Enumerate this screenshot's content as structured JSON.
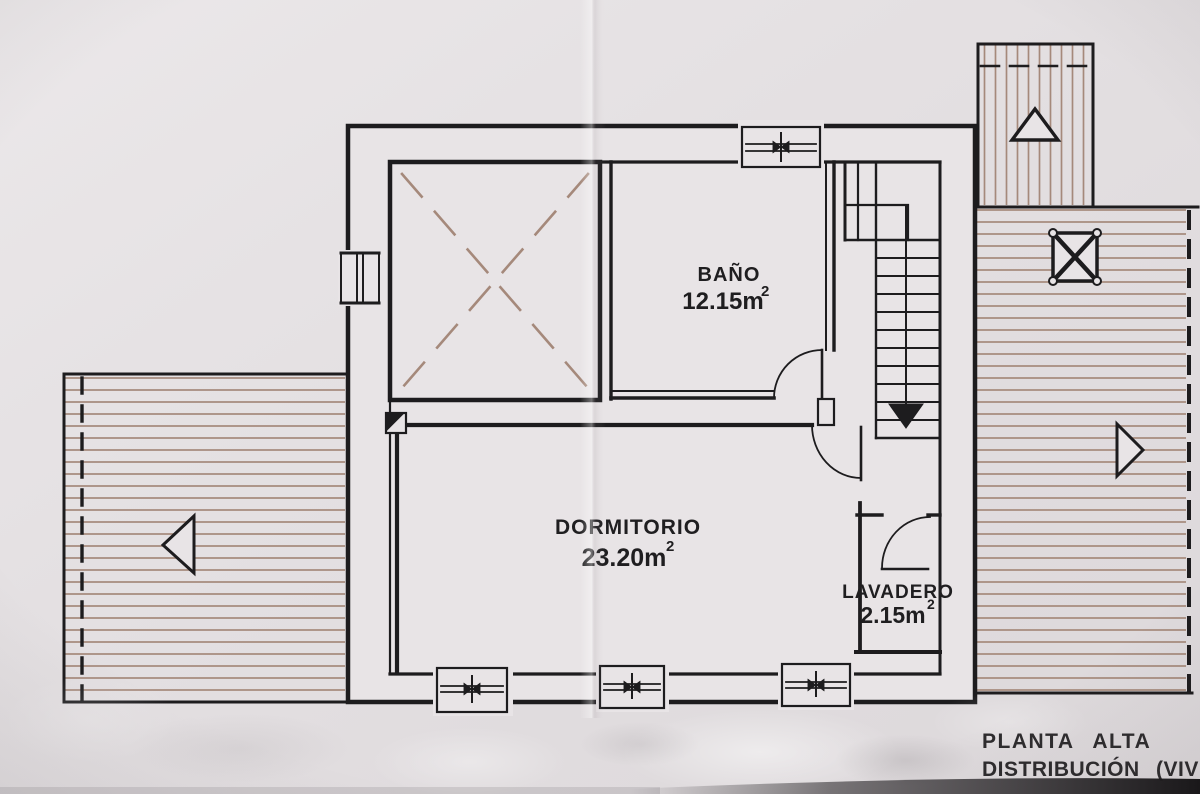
{
  "plan": {
    "title": {
      "line1": "PLANTA ALTA",
      "line2": "DISTRIBUCIÓN (VIV"
    },
    "rooms": [
      {
        "name": "BAÑO",
        "area_value": "12.15m",
        "area_sup": "2"
      },
      {
        "name": "DORMITORIO",
        "area_value": "23.20m",
        "area_sup": "2"
      },
      {
        "name": "LAVADERO",
        "area_value": "2.15m",
        "area_sup": "2"
      }
    ],
    "symbols": {
      "stairs_direction": "down-arrow",
      "void_marker": "dashed-x-cross",
      "terrace_left_arrow": "left-triangle",
      "terrace_right_arrow": "right-triangle",
      "upper_block_arrow": "up-triangle",
      "pergola_marker": "x-square-with-corner-dots",
      "boundary_line": "dashed-line",
      "window_symbol": "double-line-with-center-mullion"
    },
    "colors": {
      "paper": "#e8e4e6",
      "ink": "#1d1c1e",
      "hatch": "#a5897b",
      "title_ink": "#2e2c2e"
    }
  }
}
